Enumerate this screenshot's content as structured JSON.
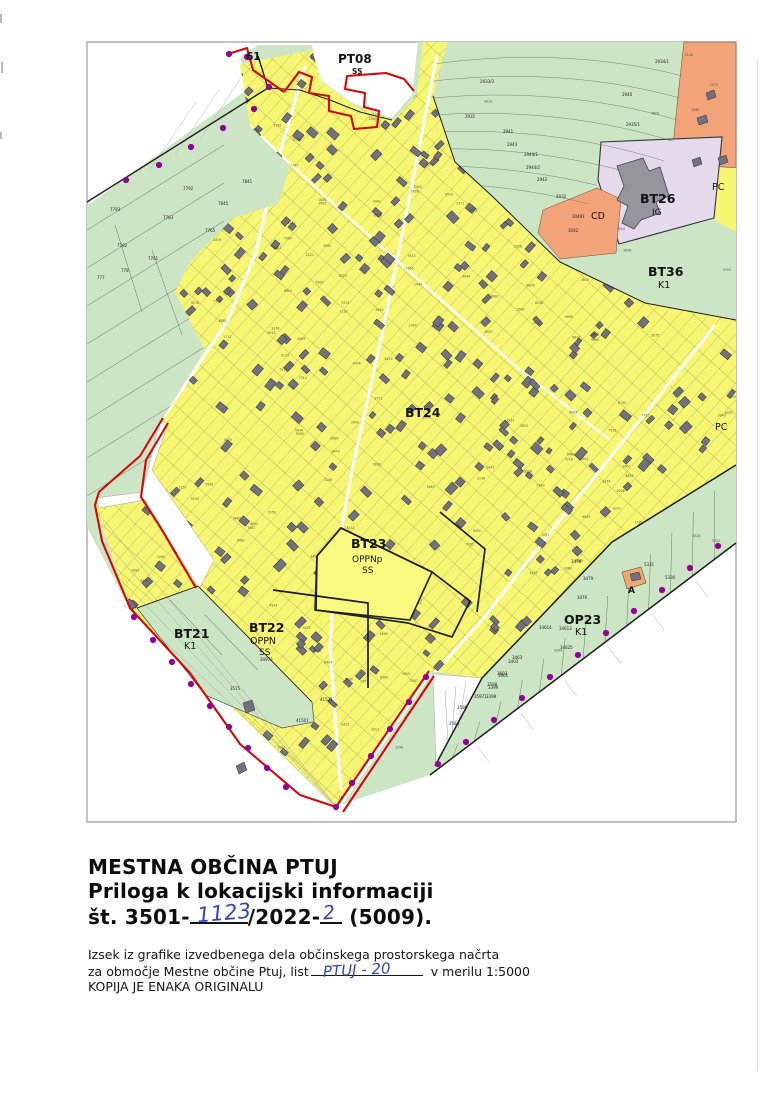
{
  "footer": {
    "title1": "MESTNA OBČINA PTUJ",
    "title2": "Priloga k lokacijski informaciji",
    "ref_prefix": "št. 3501-",
    "ref_hand1": "1123",
    "ref_mid": "/2022-",
    "ref_hand2": "2",
    "ref_suffix": "(5009).",
    "body1": "Izsek iz grafike izvedbenega dela občinskega prostorskega načrta",
    "body2a": "za območje Mestne občine Ptuj, list",
    "body2_hand": "PTUJ - 20",
    "body2b": "v merilu 1:5000",
    "body3": "KOPIJA JE ENAKA ORIGINALU"
  },
  "map": {
    "frame": {
      "x": 87,
      "y": 42,
      "w": 649,
      "h": 780,
      "stroke": "#9b9b9b"
    },
    "colors": {
      "yellow": "#f6f672",
      "green": "#cce5c5",
      "lavender": "#e4daec",
      "orange": "#f2a478",
      "olive": "#c0d02e",
      "building": "#72727e",
      "building_stroke": "#2f2f38",
      "red": "#d40808",
      "dot": "#95009b",
      "parcel_line": "#6f6f52",
      "label": "#141414",
      "hand_blue": "#2e44c3"
    },
    "zones": [
      {
        "name": "green-base",
        "fill": "green",
        "pts": [
          [
            87,
            206
          ],
          [
            252,
            86
          ],
          [
            240,
            58
          ],
          [
            258,
            45
          ],
          [
            312,
            45
          ],
          [
            318,
            78
          ],
          [
            352,
            103
          ],
          [
            392,
            118
          ],
          [
            412,
            95
          ],
          [
            418,
            42
          ],
          [
            736,
            42
          ],
          [
            736,
            543
          ],
          [
            430,
            775
          ],
          [
            337,
            806
          ],
          [
            130,
            610
          ],
          [
            87,
            527
          ]
        ]
      },
      {
        "name": "orange-northeast",
        "fill": "orange",
        "stroke": "#6b4a2f",
        "sw": 0.5,
        "pts": [
          [
            684,
            42
          ],
          [
            736,
            42
          ],
          [
            736,
            168
          ],
          [
            712,
            166
          ],
          [
            700,
            150
          ],
          [
            672,
            156
          ],
          [
            678,
            96
          ]
        ]
      },
      {
        "name": "yellow-east-sliver",
        "fill": "yellow",
        "pts": [
          [
            708,
            168
          ],
          [
            736,
            168
          ],
          [
            736,
            232
          ],
          [
            716,
            221
          ],
          [
            706,
            190
          ]
        ]
      },
      {
        "name": "lavender-bt26",
        "fill": "lavender",
        "stroke": "#33333d",
        "sw": 1.1,
        "pts": [
          [
            601,
            142
          ],
          [
            722,
            137
          ],
          [
            714,
            218
          ],
          [
            619,
            244
          ],
          [
            598,
            180
          ]
        ]
      },
      {
        "name": "orange-cd",
        "fill": "orange",
        "stroke": "#6b4a2f",
        "sw": 0.5,
        "pts": [
          [
            538,
            233
          ],
          [
            543,
            210
          ],
          [
            597,
            188
          ],
          [
            621,
            199
          ],
          [
            616,
            253
          ],
          [
            560,
            259
          ]
        ]
      },
      {
        "name": "olive-parcel",
        "fill": "olive",
        "stroke": "#555555",
        "sw": 0.5,
        "pts": [
          [
            707,
            352
          ],
          [
            729,
            346
          ],
          [
            731,
            424
          ],
          [
            712,
            419
          ]
        ]
      },
      {
        "name": "yellow-main",
        "fill": "yellow",
        "pts": [
          [
            240,
            64
          ],
          [
            312,
            50
          ],
          [
            322,
            82
          ],
          [
            355,
            106
          ],
          [
            394,
            120
          ],
          [
            417,
            94
          ],
          [
            423,
            42
          ],
          [
            447,
            42
          ],
          [
            433,
            96
          ],
          [
            455,
            162
          ],
          [
            492,
            196
          ],
          [
            560,
            262
          ],
          [
            645,
            303
          ],
          [
            736,
            320
          ],
          [
            736,
            465
          ],
          [
            612,
            542
          ],
          [
            482,
            678
          ],
          [
            429,
            671
          ],
          [
            336,
            807
          ],
          [
            130,
            610
          ],
          [
            95,
            505
          ],
          [
            141,
            497
          ],
          [
            163,
            418
          ],
          [
            205,
            350
          ],
          [
            175,
            292
          ],
          [
            190,
            262
          ],
          [
            233,
            218
          ],
          [
            278,
            204
          ],
          [
            290,
            166
          ],
          [
            250,
            126
          ]
        ]
      }
    ],
    "bt26_building": [
      [
        617,
        166
      ],
      [
        643,
        158
      ],
      [
        649,
        171
      ],
      [
        660,
        167
      ],
      [
        669,
        196
      ],
      [
        656,
        202
      ],
      [
        660,
        213
      ],
      [
        641,
        220
      ],
      [
        634,
        229
      ],
      [
        622,
        223
      ],
      [
        628,
        206
      ],
      [
        617,
        200
      ],
      [
        624,
        186
      ]
    ],
    "extra_buildings": [
      [
        [
          697,
          118
        ],
        [
          706,
          115
        ],
        [
          708,
          122
        ],
        [
          699,
          125
        ]
      ],
      [
        [
          706,
          93
        ],
        [
          714,
          90
        ],
        [
          716,
          97
        ],
        [
          708,
          100
        ]
      ],
      [
        [
          692,
          160
        ],
        [
          700,
          157
        ],
        [
          702,
          164
        ],
        [
          694,
          167
        ]
      ],
      [
        [
          718,
          158
        ],
        [
          726,
          155
        ],
        [
          728,
          162
        ],
        [
          720,
          165
        ]
      ],
      [
        [
          630,
          574
        ],
        [
          639,
          572
        ],
        [
          641,
          579
        ],
        [
          632,
          581
        ]
      ],
      [
        [
          243,
          703
        ],
        [
          252,
          700
        ],
        [
          255,
          710
        ],
        [
          246,
          713
        ]
      ],
      [
        [
          236,
          766
        ],
        [
          244,
          762
        ],
        [
          247,
          770
        ],
        [
          239,
          774
        ]
      ]
    ],
    "overlays": [
      {
        "name": "white-parcels-east-of-tip",
        "fill": "#ffffff",
        "stroke": "#9a9a9a",
        "sw": 0.4,
        "pts": [
          [
            433,
            674
          ],
          [
            482,
            678
          ],
          [
            436,
            764
          ]
        ]
      },
      {
        "name": "bt23-open-parcel",
        "fill": "#f9f980",
        "stroke": "#222222",
        "sw": 1.6,
        "pts": [
          [
            317,
            556
          ],
          [
            341,
            528
          ],
          [
            432,
            572
          ],
          [
            410,
            620
          ],
          [
            315,
            610
          ]
        ]
      },
      {
        "name": "white-road-corridor",
        "fill": "#ffffff",
        "stroke": "#8a8a8a",
        "sw": 0.4,
        "pts": [
          [
            160,
            420
          ],
          [
            168,
            424
          ],
          [
            152,
            470
          ],
          [
            214,
            560
          ],
          [
            199,
            589
          ],
          [
            145,
            500
          ],
          [
            99,
            508
          ],
          [
            96,
            498
          ],
          [
            142,
            492
          ],
          [
            150,
            462
          ]
        ]
      },
      {
        "name": "green-wedge-bt21",
        "fill": "green",
        "stroke": "#44503f",
        "sw": 0.7,
        "pts": [
          [
            137,
            608
          ],
          [
            198,
            586
          ],
          [
            312,
            702
          ],
          [
            314,
            722
          ],
          [
            282,
            728
          ],
          [
            205,
            695
          ]
        ]
      },
      {
        "name": "orange-parcel-a",
        "fill": "#f0a86e",
        "stroke": "#333333",
        "sw": 0.5,
        "pts": [
          [
            622,
            572
          ],
          [
            641,
            567
          ],
          [
            646,
            583
          ],
          [
            627,
            589
          ]
        ]
      }
    ],
    "black_paths": [
      {
        "name": "boundary-northwest",
        "d": "M87,202 L268,88 L258,56",
        "w": 1.4
      },
      {
        "name": "boundary-north-notch",
        "d": "M268,88 L300,90 L330,100 L360,112 L392,120",
        "w": 1.0
      },
      {
        "name": "boundary-yellow-green-east",
        "d": "M433,96 L455,162 L492,196 L560,262 L645,303 L736,320",
        "w": 1.0
      },
      {
        "name": "boundary-op23-upper",
        "d": "M736,465 L612,542 L482,678 L435,766",
        "w": 1.5
      },
      {
        "name": "boundary-op23-lower",
        "d": "M736,543 L430,775",
        "w": 1.5
      },
      {
        "name": "oppn-boundary-bt23",
        "d": "M317,556 L341,528 L432,572 L470,601 L452,637 L408,623 L316,610 L317,556",
        "w": 1.7
      },
      {
        "name": "oppn-boundary-bt22-east",
        "d": "M273,590 L368,603 L368,688",
        "w": 1.7
      },
      {
        "name": "oppn-boundary-bt22-north",
        "d": "M440,512 L485,549 L477,612",
        "w": 1.7
      },
      {
        "name": "wedge-top-line",
        "d": "M137,608 L198,586 L312,702",
        "w": 0.8
      }
    ],
    "red_paths": [
      {
        "d": "M228,54 L247,48 L253,70 L284,92"
      },
      {
        "d": "M284,92 L299,72 L312,77 L309,93 L329,96 L329,111 L351,116 L354,129 L377,127 L379,111 L364,107 L365,93 L345,89 L347,76 L386,73 L404,79 L414,91"
      },
      {
        "d": "M163,418 L140,456 L99,492 L95,505 L102,541 L130,608 L190,673 L240,744 L300,795 L336,807"
      },
      {
        "d": "M168,423 L146,460 L141,497 L162,530 L196,588"
      },
      {
        "d": "M336,807 L429,671"
      },
      {
        "d": "M343,812 L434,676"
      }
    ],
    "dots": [
      [
        247,
        57
      ],
      [
        269,
        87
      ],
      [
        254,
        109
      ],
      [
        223,
        128
      ],
      [
        191,
        147
      ],
      [
        159,
        165
      ],
      [
        126,
        180
      ],
      [
        229,
        54
      ],
      [
        134,
        617
      ],
      [
        153,
        640
      ],
      [
        172,
        662
      ],
      [
        191,
        684
      ],
      [
        210,
        706
      ],
      [
        229,
        727
      ],
      [
        248,
        748
      ],
      [
        267,
        768
      ],
      [
        286,
        787
      ],
      [
        336,
        807
      ],
      [
        352,
        783
      ],
      [
        371,
        756
      ],
      [
        390,
        729
      ],
      [
        409,
        702
      ],
      [
        426,
        677
      ],
      [
        718,
        546
      ],
      [
        690,
        568
      ],
      [
        662,
        590
      ],
      [
        634,
        611
      ],
      [
        606,
        633
      ],
      [
        578,
        655
      ],
      [
        550,
        677
      ],
      [
        522,
        698
      ],
      [
        494,
        720
      ],
      [
        466,
        742
      ],
      [
        438,
        764
      ]
    ],
    "roads": [
      {
        "d": "M305,66 L278,160 L255,255 L228,320 L163,418",
        "w": 3.2
      },
      {
        "d": "M437,55 L412,185 L383,330 L352,470 L336,560 L330,645 L336,730 L341,790",
        "w": 3.0
      },
      {
        "d": "M715,325 L640,420 L560,520 L482,620 L432,676",
        "w": 3.0
      },
      {
        "d": "M250,126 L340,210 L430,290 L520,370 L610,440",
        "w": 2.2
      }
    ],
    "labels": [
      {
        "t": "61",
        "x": 246,
        "y": 60,
        "s": 10.5,
        "b": true
      },
      {
        "t": "PT08",
        "x": 338,
        "y": 63,
        "s": 12,
        "b": true
      },
      {
        "t": "SS",
        "x": 352,
        "y": 74,
        "s": 7.5,
        "b": true
      },
      {
        "t": "BT26",
        "x": 640,
        "y": 203,
        "s": 12.5,
        "b": true
      },
      {
        "t": "IG",
        "x": 652,
        "y": 215,
        "s": 9
      },
      {
        "t": "CD",
        "x": 591,
        "y": 219,
        "s": 9.5
      },
      {
        "t": "BT36",
        "x": 648,
        "y": 276,
        "s": 12.5,
        "b": true
      },
      {
        "t": "K1",
        "x": 658,
        "y": 288,
        "s": 9.5
      },
      {
        "t": "PC",
        "x": 712,
        "y": 190,
        "s": 9.5
      },
      {
        "t": "PC",
        "x": 715,
        "y": 430,
        "s": 9.5
      },
      {
        "t": "BT24",
        "x": 405,
        "y": 417,
        "s": 12.5,
        "b": true
      },
      {
        "t": "BT23",
        "x": 351,
        "y": 548,
        "s": 12.5,
        "b": true
      },
      {
        "t": "OPPNp",
        "x": 352,
        "y": 562,
        "s": 9
      },
      {
        "t": "SS",
        "x": 362,
        "y": 573,
        "s": 9
      },
      {
        "t": "BT22",
        "x": 249,
        "y": 632,
        "s": 12.5,
        "b": true
      },
      {
        "t": "OPPN",
        "x": 250,
        "y": 644,
        "s": 9.5
      },
      {
        "t": "SS",
        "x": 259,
        "y": 655,
        "s": 9
      },
      {
        "t": "BT21",
        "x": 174,
        "y": 638,
        "s": 12.5,
        "b": true
      },
      {
        "t": "K1",
        "x": 184,
        "y": 649,
        "s": 9.5
      },
      {
        "t": "OP23",
        "x": 564,
        "y": 624,
        "s": 12.5,
        "b": true
      },
      {
        "t": "K1",
        "x": 575,
        "y": 635,
        "s": 9.5
      },
      {
        "t": "A",
        "x": 628,
        "y": 593,
        "s": 9,
        "b": true
      }
    ],
    "parcel_labels": [
      [
        "7793",
        110,
        211
      ],
      [
        "7763",
        163,
        219
      ],
      [
        "7841",
        242,
        183
      ],
      [
        "7845",
        218,
        205
      ],
      [
        "7792",
        183,
        190
      ],
      [
        "7761",
        148,
        260
      ],
      [
        "778",
        121,
        272
      ],
      [
        "777",
        97,
        279
      ],
      [
        "7782",
        117,
        247
      ],
      [
        "7765",
        205,
        232
      ],
      [
        "2933/3",
        480,
        83
      ],
      [
        "2934/1",
        655,
        63
      ],
      [
        "2931",
        465,
        118
      ],
      [
        "2940",
        622,
        96
      ],
      [
        "2935/1",
        626,
        126
      ],
      [
        "2941",
        503,
        133
      ],
      [
        "2944/1",
        524,
        156
      ],
      [
        "2944/2",
        526,
        169
      ],
      [
        "2942",
        537,
        181
      ],
      [
        "2932",
        556,
        198
      ],
      [
        "2943",
        507,
        146
      ],
      [
        "3042",
        568,
        232
      ],
      [
        "30491",
        572,
        218
      ],
      [
        "3478",
        571,
        563
      ],
      [
        "3479",
        583,
        580
      ],
      [
        "3476",
        577,
        599
      ],
      [
        "34614",
        539,
        629
      ],
      [
        "34613",
        559,
        630
      ],
      [
        "34625",
        560,
        649
      ],
      [
        "3403",
        508,
        663
      ],
      [
        "3401",
        498,
        677
      ],
      [
        "3399",
        488,
        689
      ],
      [
        "5331",
        644,
        566
      ],
      [
        "5330",
        665,
        579
      ],
      [
        "3398",
        486,
        698
      ],
      [
        "3584",
        449,
        725
      ],
      [
        "3586",
        457,
        709
      ],
      [
        "35971",
        474,
        698
      ],
      [
        "3598",
        487,
        686
      ],
      [
        "3603",
        497,
        675
      ],
      [
        "3463",
        512,
        659
      ],
      [
        "41521",
        320,
        701
      ],
      [
        "41501",
        296,
        722
      ],
      [
        "34973",
        260,
        661
      ],
      [
        "3575",
        230,
        690
      ]
    ]
  }
}
